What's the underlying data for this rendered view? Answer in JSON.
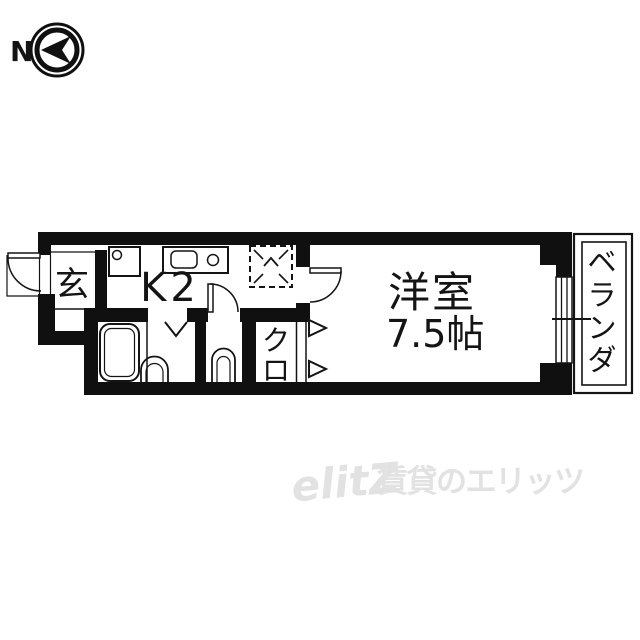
{
  "compass": {
    "label": "N"
  },
  "floorplan": {
    "rooms": {
      "genkan": {
        "label": "玄"
      },
      "kitchen": {
        "label": "K2"
      },
      "closet": {
        "chars": [
          "ク",
          "ロ"
        ]
      },
      "western_room": {
        "label": "洋室",
        "size": "7.5帖"
      },
      "veranda": {
        "chars": [
          "ベ",
          "ラ",
          "ン",
          "ダ"
        ]
      }
    }
  },
  "watermark": {
    "logo": "elitZ",
    "brand_text": "賃貸のエリッツ"
  },
  "colors": {
    "wall": "#101010",
    "line": "#141414",
    "watermark": "#e2e2e2"
  }
}
